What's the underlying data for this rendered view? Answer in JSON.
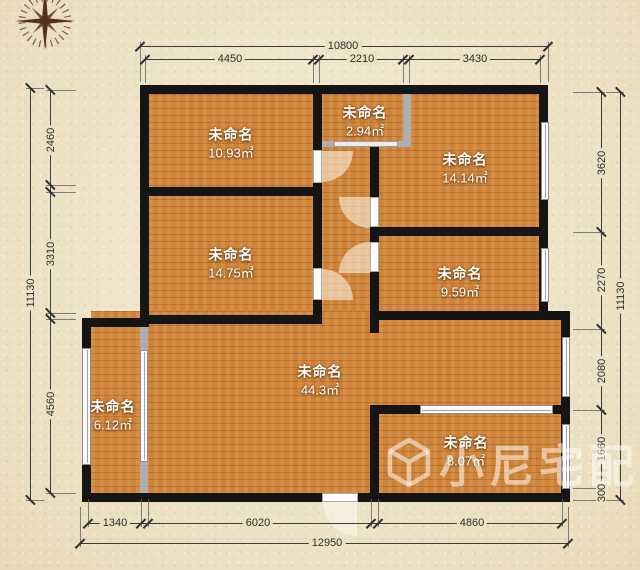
{
  "watermark": {
    "text": "小尼宅配",
    "logo": "cube-outline",
    "color": "rgba(255,255,255,0.52)"
  },
  "compass": {
    "icon": "compass-rose",
    "color": "#451e0e"
  },
  "palette": {
    "background": "#eee2c5",
    "floor": "#d2873c",
    "wall": "#151515",
    "dim_text": "#2d2d2d",
    "room_text": "#ffffff"
  },
  "rooms": [
    {
      "name": "未命名",
      "area": "10.93㎡",
      "cx": 231,
      "cy": 144
    },
    {
      "name": "未命名",
      "area": "2.94㎡",
      "cx": 365,
      "cy": 122
    },
    {
      "name": "未命名",
      "area": "14.14㎡",
      "cx": 465,
      "cy": 169
    },
    {
      "name": "未命名",
      "area": "14.75㎡",
      "cx": 231,
      "cy": 264
    },
    {
      "name": "未命名",
      "area": "9.59㎡",
      "cx": 460,
      "cy": 283
    },
    {
      "name": "未命名",
      "area": "44.3㎡",
      "cx": 320,
      "cy": 381
    },
    {
      "name": "未命名",
      "area": "6.12㎡",
      "cx": 113,
      "cy": 416
    },
    {
      "name": "未命名",
      "area": "8.07㎡",
      "cx": 466,
      "cy": 452
    }
  ],
  "dim_lines": [
    {
      "o": "h",
      "pos": 46,
      "from": 140,
      "to": 548,
      "dir": 1,
      "ext": 36,
      "ticks": [
        140,
        548
      ],
      "labels": [
        {
          "t": "10800",
          "at": 343
        }
      ]
    },
    {
      "o": "h",
      "pos": 59,
      "from": 145,
      "to": 541,
      "dir": 1,
      "ext": 24,
      "ticks": [
        145,
        313,
        319,
        403,
        409,
        540
      ],
      "labels": [
        {
          "t": "4450",
          "at": 230
        },
        {
          "t": "2210",
          "at": 362
        },
        {
          "t": "3430",
          "at": 475
        }
      ]
    },
    {
      "o": "v",
      "pos": 30,
      "from": 88,
      "to": 500,
      "dir": 1,
      "ext": 14,
      "ticks": [
        88,
        500
      ],
      "labels": [
        {
          "t": "11130",
          "at": 293
        }
      ]
    },
    {
      "o": "v",
      "pos": 50,
      "from": 90,
      "to": 493,
      "dir": 1,
      "ext": 26,
      "ticks": [
        90,
        185,
        192,
        313,
        319,
        493
      ],
      "labels": [
        {
          "t": "2460",
          "at": 140
        },
        {
          "t": "3310",
          "at": 254
        },
        {
          "t": "4560",
          "at": 404
        }
      ]
    },
    {
      "o": "v",
      "pos": 601,
      "from": 92,
      "to": 500,
      "dir": -1,
      "ext": 28,
      "ticks": [
        92,
        232,
        329,
        410,
        488,
        500
      ],
      "labels": [
        {
          "t": "3620",
          "at": 163
        },
        {
          "t": "2270",
          "at": 280
        },
        {
          "t": "2080",
          "at": 371
        },
        {
          "t": "1660",
          "at": 449
        },
        {
          "t": "300",
          "at": 493
        }
      ]
    },
    {
      "o": "v",
      "pos": 620,
      "from": 92,
      "to": 500,
      "dir": -1,
      "ext": 14,
      "ticks": [
        92,
        500
      ],
      "labels": [
        {
          "t": "11130",
          "at": 296
        }
      ]
    },
    {
      "o": "h",
      "pos": 523,
      "from": 88,
      "to": 562,
      "dir": -1,
      "ext": 24,
      "ticks": [
        88,
        141,
        148,
        371,
        378,
        562
      ],
      "labels": [
        {
          "t": "1340",
          "at": 115
        },
        {
          "t": "6020",
          "at": 258
        },
        {
          "t": "4860",
          "at": 472
        }
      ]
    },
    {
      "o": "h",
      "pos": 543,
      "from": 80,
      "to": 568,
      "dir": -1,
      "ext": 36,
      "ticks": [
        80,
        568
      ],
      "labels": [
        {
          "t": "12950",
          "at": 327
        }
      ]
    }
  ],
  "plan_geometry": {
    "floors": [
      [
        149,
        94,
        390,
        230
      ],
      [
        91,
        311,
        470,
        182
      ]
    ],
    "walls": [
      [
        140,
        85,
        408,
        9
      ],
      [
        140,
        85,
        9,
        239
      ],
      [
        82,
        318,
        67,
        9
      ],
      [
        82,
        318,
        9,
        184
      ],
      [
        82,
        493,
        240,
        9
      ],
      [
        358,
        493,
        212,
        9
      ],
      [
        539,
        85,
        9,
        226
      ],
      [
        370,
        311,
        200,
        9
      ],
      [
        561,
        311,
        9,
        191
      ],
      [
        313,
        94,
        9,
        56
      ],
      [
        313,
        183,
        9,
        87
      ],
      [
        313,
        300,
        9,
        24
      ],
      [
        140,
        187,
        182,
        9
      ],
      [
        140,
        315,
        182,
        9
      ],
      [
        370,
        147,
        9,
        50
      ],
      [
        370,
        227,
        9,
        15
      ],
      [
        370,
        272,
        9,
        61
      ],
      [
        370,
        227,
        178,
        9
      ],
      [
        370,
        405,
        9,
        97
      ],
      [
        370,
        405,
        50,
        9
      ],
      [
        553,
        405,
        8,
        9
      ]
    ],
    "gray_walls": [
      [
        322,
        141,
        89,
        6
      ],
      [
        403,
        94,
        8,
        50
      ],
      [
        140,
        324,
        8,
        28
      ],
      [
        140,
        460,
        8,
        33
      ]
    ],
    "insets": [
      [
        334,
        141,
        64,
        6
      ]
    ],
    "windows": [
      {
        "x": 541,
        "y": 122,
        "w": 8,
        "h": 78,
        "o": "v"
      },
      {
        "x": 541,
        "y": 248,
        "w": 8,
        "h": 54,
        "o": "v"
      },
      {
        "x": 82,
        "y": 348,
        "w": 9,
        "h": 117,
        "o": "v"
      },
      {
        "x": 562,
        "y": 337,
        "w": 8,
        "h": 60,
        "o": "v"
      },
      {
        "x": 562,
        "y": 424,
        "w": 8,
        "h": 65,
        "o": "v"
      },
      {
        "x": 420,
        "y": 405,
        "w": 133,
        "h": 9,
        "o": "h"
      },
      {
        "x": 140,
        "y": 350,
        "w": 8,
        "h": 112,
        "o": "v"
      }
    ],
    "door_leaves": [
      [
        313,
        150,
        9,
        33
      ],
      [
        313,
        268,
        9,
        32
      ],
      [
        370,
        197,
        9,
        30
      ],
      [
        370,
        242,
        9,
        30
      ],
      [
        322,
        493,
        36,
        9
      ]
    ],
    "door_fans": [
      {
        "x": 322,
        "y": 151,
        "s": 31,
        "r": "0 0 100% 0"
      },
      {
        "x": 322,
        "y": 269,
        "s": 31,
        "r": "0 100% 0 0"
      },
      {
        "x": 339,
        "y": 197,
        "s": 31,
        "r": "0 0 0 100%"
      },
      {
        "x": 339,
        "y": 242,
        "s": 31,
        "r": "100% 0 0 0"
      },
      {
        "x": 323,
        "y": 502,
        "s": 34,
        "r": "0 0 0 100%"
      }
    ]
  }
}
